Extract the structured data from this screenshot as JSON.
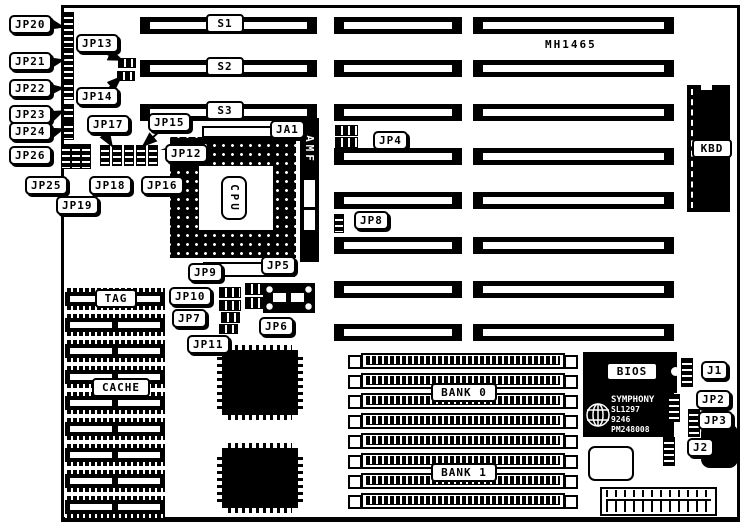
{
  "colors": {
    "ink": "#000000",
    "paper": "#ffffff"
  },
  "board": {
    "model": "MH1465"
  },
  "callouts": {
    "jp20": "JP20",
    "jp21": "JP21",
    "jp22": "JP22",
    "jp23": "JP23",
    "jp24": "JP24",
    "jp26": "JP26",
    "jp25": "JP25",
    "jp19": "JP19",
    "jp13": "JP13",
    "jp14": "JP14",
    "jp17": "JP17",
    "jp15": "JP15",
    "jp12": "JP12",
    "jp18": "JP18",
    "jp16": "JP16",
    "ja1": "JA1",
    "jp4": "JP4",
    "jp8": "JP8",
    "jp9": "JP9",
    "jp5": "JP5",
    "jp10": "JP10",
    "jp7": "JP7",
    "jp6": "JP6",
    "jp11": "JP11",
    "j1": "J1",
    "jp2": "JP2",
    "jp3": "JP3",
    "j2": "J2"
  },
  "labels": {
    "s1": "S1",
    "s2": "S2",
    "s3": "S3",
    "kbd": "KBD",
    "cpu": "CPU",
    "amf": "AMF",
    "tag": "TAG",
    "cache": "CACHE",
    "bank0": "BANK 0",
    "bank1": "BANK 1",
    "bios": "BIOS"
  },
  "chip_markings": {
    "brand": "SYMPHONY",
    "part": "SL1297",
    "date_code": "9246",
    "serial": "PM248008"
  }
}
